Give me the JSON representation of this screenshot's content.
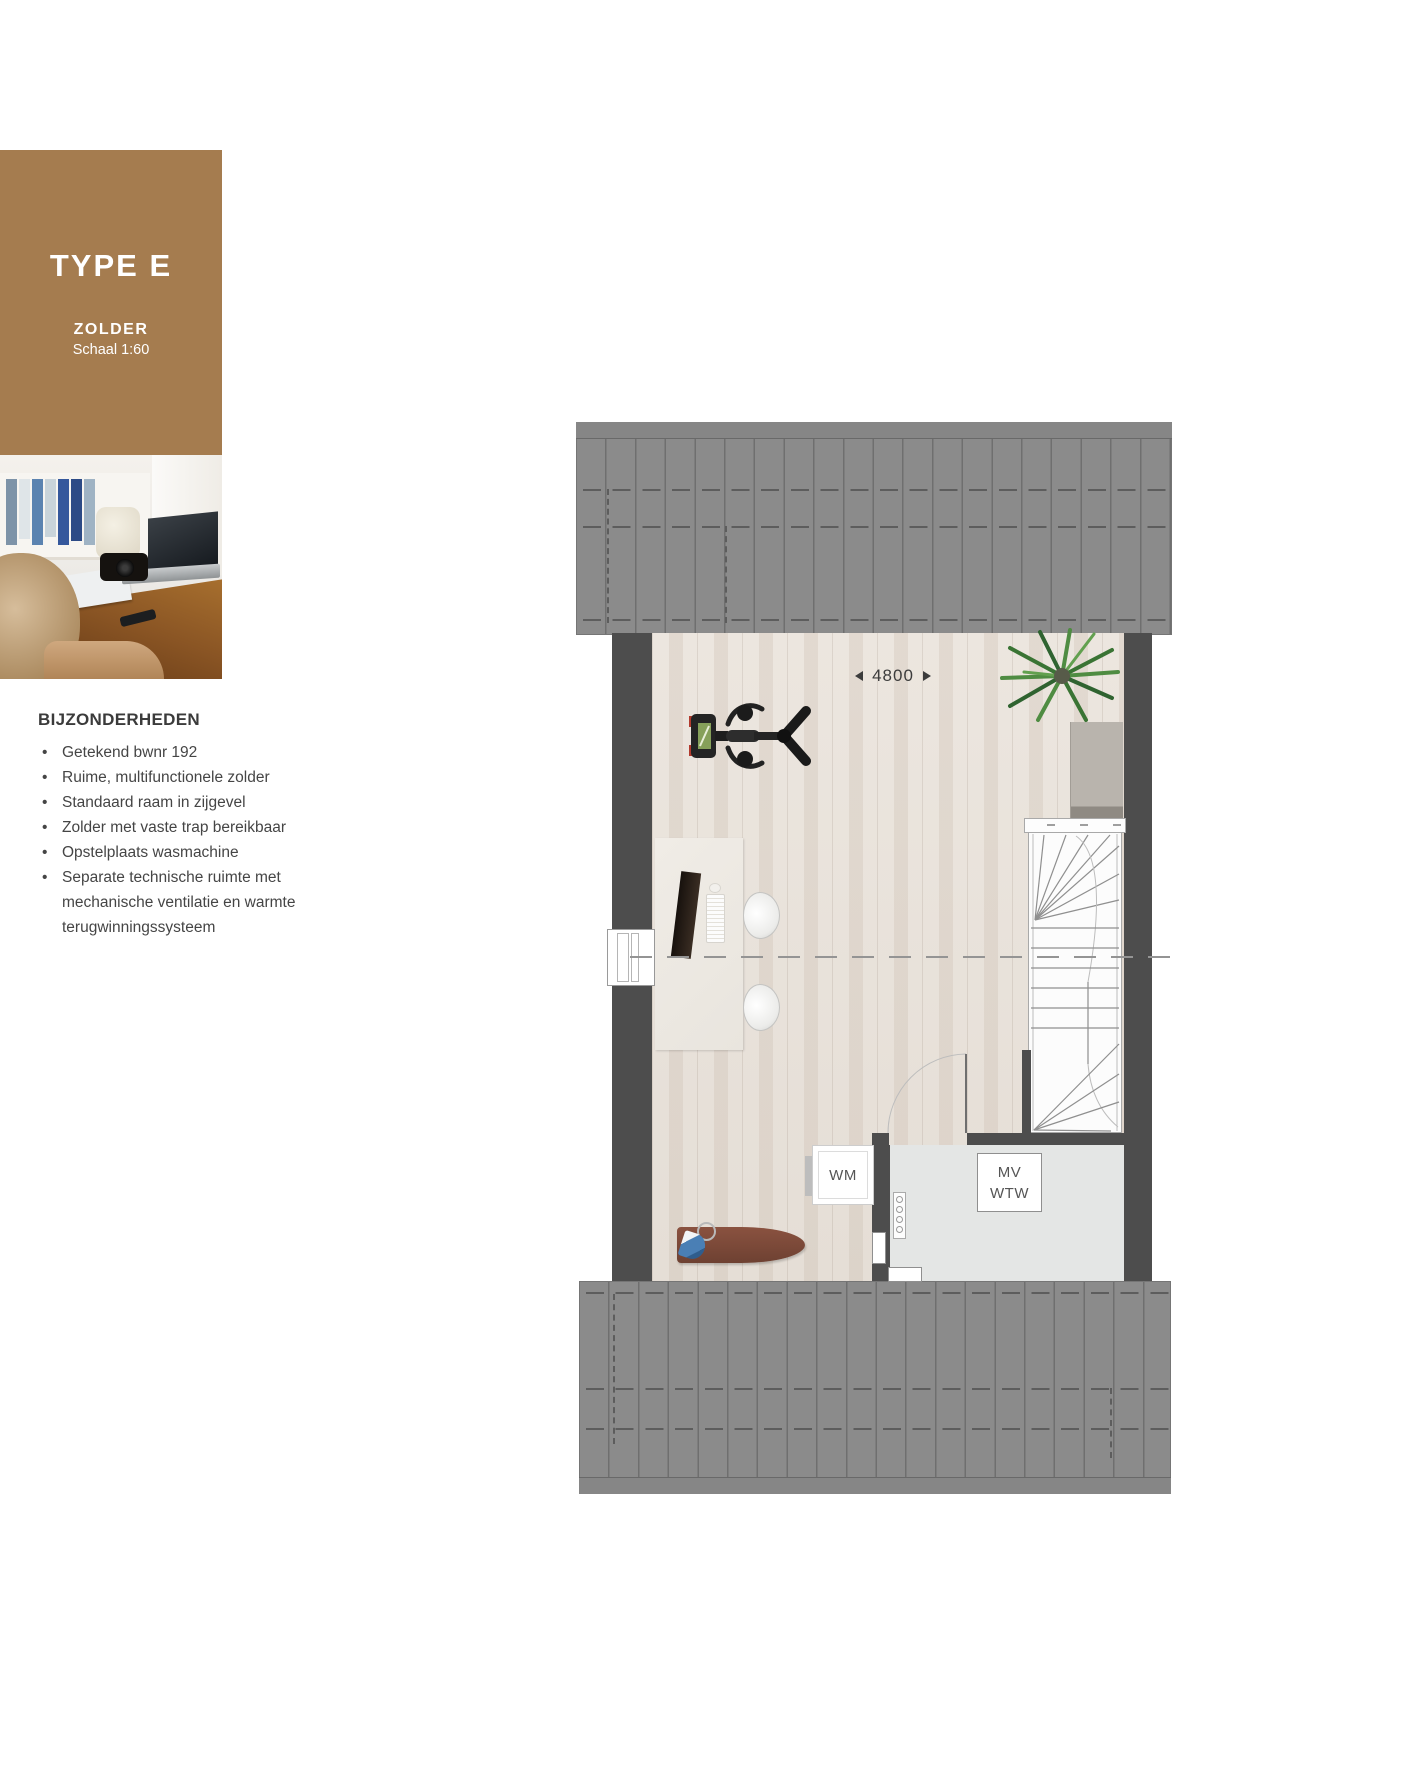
{
  "type_card": {
    "title": "TYPE E",
    "floor_label": "ZOLDER",
    "scale_label": "Schaal 1:60",
    "background_color": "#A57C4F"
  },
  "details": {
    "heading": "BIJZONDERHEDEN",
    "items": [
      "Getekend bwnr 192",
      "Ruime, multifunctionele zolder",
      "Standaard raam in zijgevel",
      "Zolder met vaste trap bereikbaar",
      "Opstelplaats wasmachine",
      "Separate technische ruimte met mechanische ventilatie en warmte terugwinningssysteem"
    ]
  },
  "plan": {
    "dimension_width": "4800",
    "washing_machine_label": "WM",
    "mech_vent_label": "MV",
    "heat_recovery_label": "WTW",
    "colors": {
      "wall": "#4D4D4D",
      "roof": "#8B8B8B",
      "wood_floor": "#E9E2DB",
      "tech_floor": "#E4E6E5"
    }
  }
}
